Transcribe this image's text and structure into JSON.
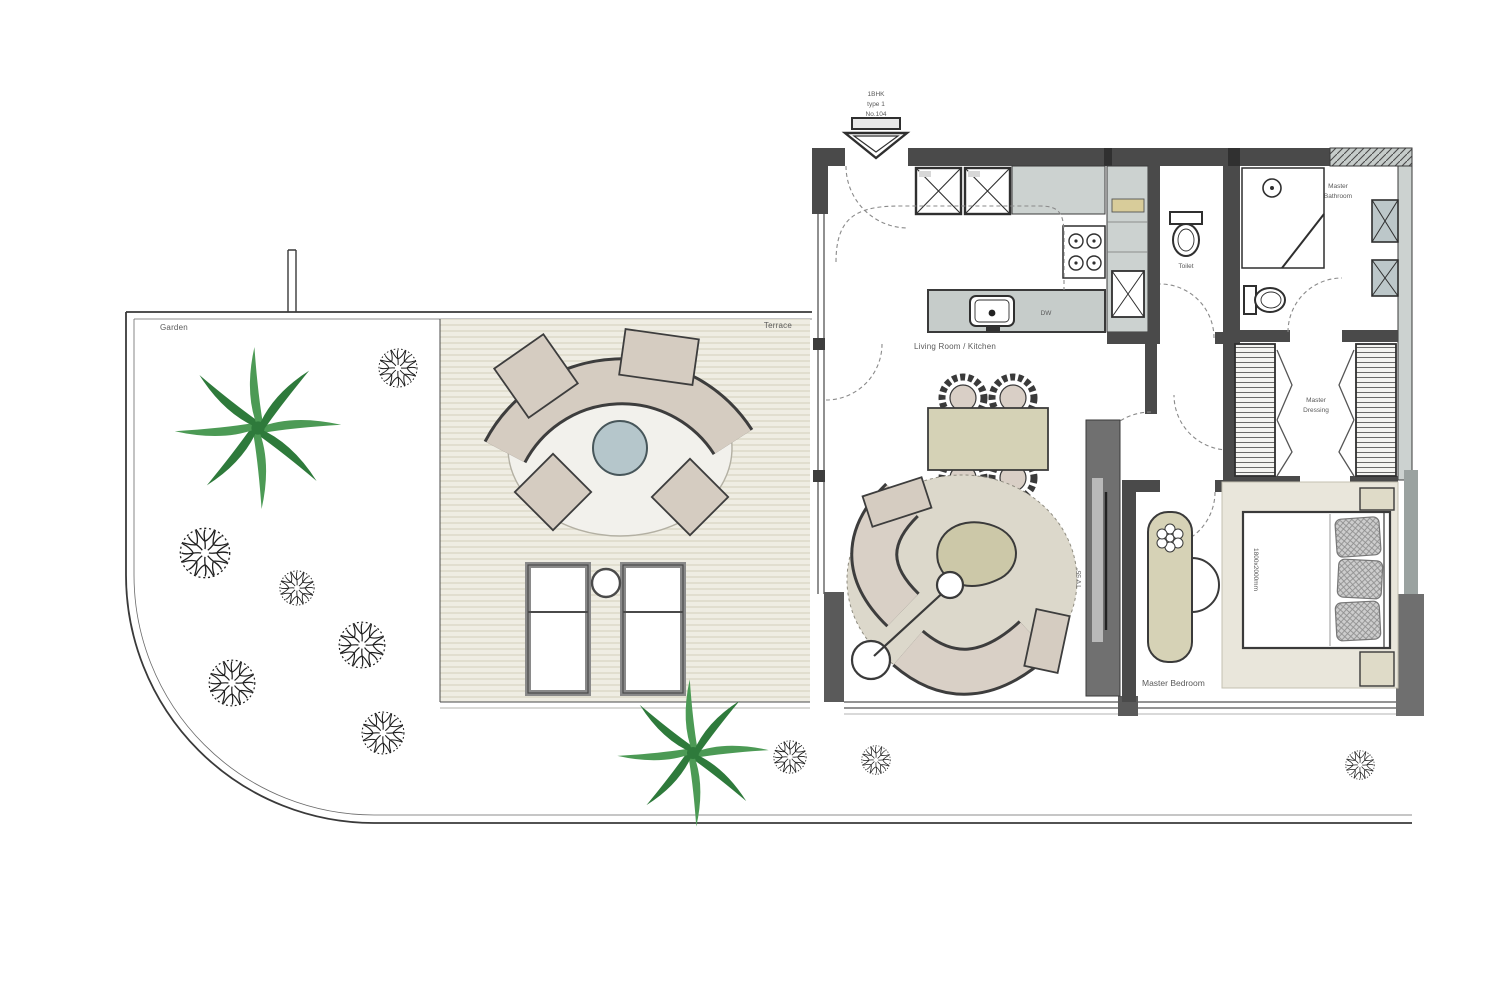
{
  "plan": {
    "unit_tag": {
      "line1": "1BHK",
      "line2": "type 1",
      "line3": "No.104"
    },
    "labels": {
      "garden": "Garden",
      "terrace": "Terrace",
      "living_kitchen": "Living Room / Kitchen",
      "toilet": "Toilet",
      "master_bathroom_1": "Master",
      "master_bathroom_2": "Bathroom",
      "master_dressing_1": "Master",
      "master_dressing_2": "Dressing",
      "master_bedroom": "Master Bedroom",
      "dishwasher": "DW",
      "tv": "TV 55\"",
      "bed_size": "1800x2000mm"
    },
    "colors": {
      "wall_dark": "#4a4a4a",
      "wall_light": "#ccd2d0",
      "unit_blue": "#bcc7c9",
      "deck": "#efede3",
      "deck_stripe": "#e1decf",
      "rug_living": "#dcd8cb",
      "rug_terrace": "#f2f1ec",
      "rug_bedroom": "#e9e6db",
      "sofa_tan": "#d5ccc1",
      "table_olive": "#d5d2b6",
      "table_round_blue": "#b5c6cb",
      "palm_green": "#4c9a55",
      "palm_green_dark": "#2e7a3b",
      "line_ink": "#2f2f2f"
    }
  }
}
